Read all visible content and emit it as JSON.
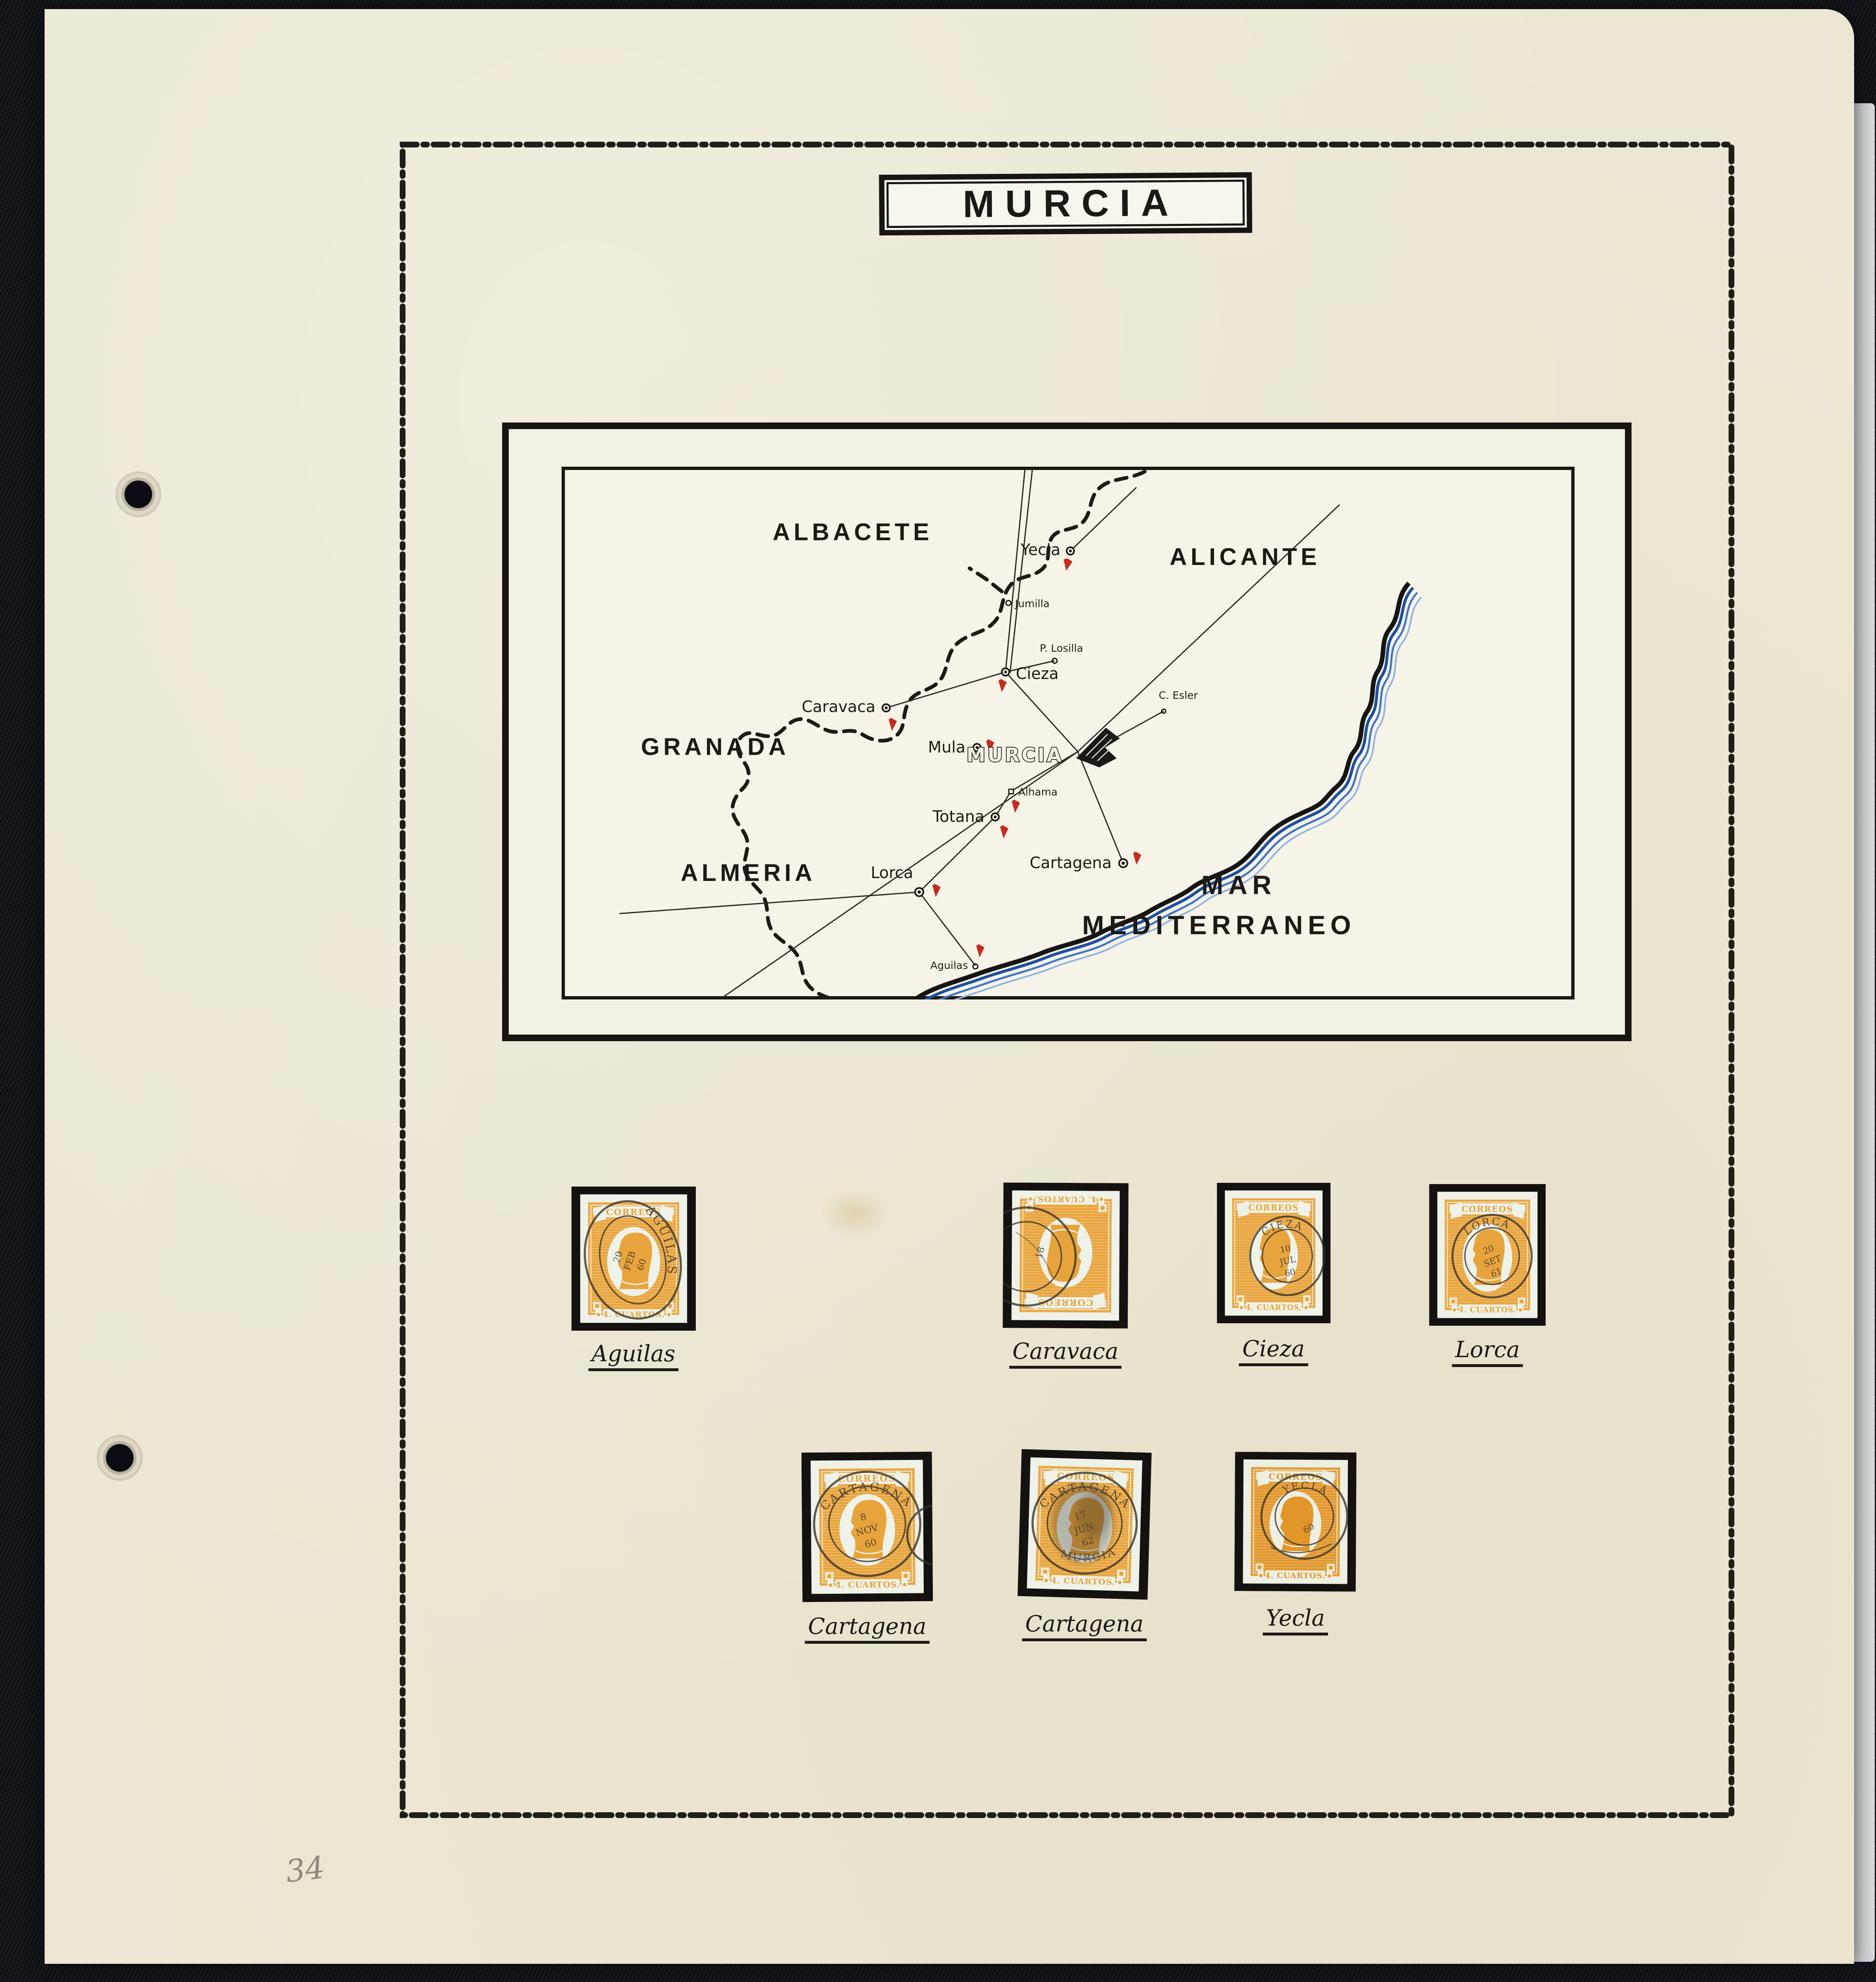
{
  "colors": {
    "album_background": "#101217",
    "page_background": "#ece7d4",
    "ink_black": "#1c1a17",
    "stamp_orange": "#e8a43c",
    "stamp_orange_deep": "#e2962a",
    "stamp_paper": "#eef2e8",
    "flag_red": "#c62b1e",
    "coast_blue": "#1d4f9e",
    "postmark_ink": "#34302a",
    "pencil_gray": "#8f897a"
  },
  "page": {
    "number": "34"
  },
  "title": {
    "label": "MURCIA"
  },
  "map": {
    "regions": {
      "albacete": "ALBACETE",
      "alicante": "ALICANTE",
      "granada": "GRANADA",
      "almeria": "ALMERIA"
    },
    "sea": {
      "line1": "MAR",
      "line2": "MEDITERRANEO"
    },
    "capital": "MURCIA",
    "cities": {
      "yecla": "Yecla",
      "jumilla": "Jumilla",
      "cieza": "Cieza",
      "losilla": "P. Losilla",
      "esler": "C. Esler",
      "caravaca": "Caravaca",
      "mula": "Mula",
      "alhama": "Alhama",
      "totana": "Totana",
      "lorca": "Lorca",
      "cartagena": "Cartagena",
      "aguilas": "Aguilas"
    }
  },
  "stamps": {
    "inscription": "CORREOS",
    "denomination": "4. CUARTOS.",
    "style_normal": "--orange:#e8a43c;--paper:#eef2e8",
    "style_deep": "--orange:#e2962a;--paper:#ecefe2",
    "items": [
      {
        "caption": "Aguilas",
        "pm_city": "AGUILAS",
        "d1": "20",
        "d2": "FEB",
        "d3": "60",
        "pm_bottom": ""
      },
      {
        "caption": "Caravaca",
        "pm_city": "",
        "d1": "18",
        "d2": "",
        "d3": "",
        "pm_bottom": ""
      },
      {
        "caption": "Cieza",
        "pm_city": "CIEZA",
        "d1": "10",
        "d2": "JUL",
        "d3": "60",
        "pm_bottom": ""
      },
      {
        "caption": "Lorca",
        "pm_city": "LORCA",
        "d1": "20",
        "d2": "SET",
        "d3": "61",
        "pm_bottom": ""
      },
      {
        "caption": "Cartagena",
        "pm_city": "CARTAGENA",
        "d1": "8",
        "d2": "NOV",
        "d3": "60",
        "pm_bottom": ""
      },
      {
        "caption": "Cartagena",
        "pm_city": "CARTAGENA",
        "d1": "17",
        "d2": "JUN",
        "d3": "62",
        "pm_bottom": "MURCIA"
      },
      {
        "caption": "Yecla",
        "pm_city": "YECLA",
        "d1": "60",
        "d2": "",
        "d3": "",
        "pm_bottom": ""
      }
    ]
  }
}
